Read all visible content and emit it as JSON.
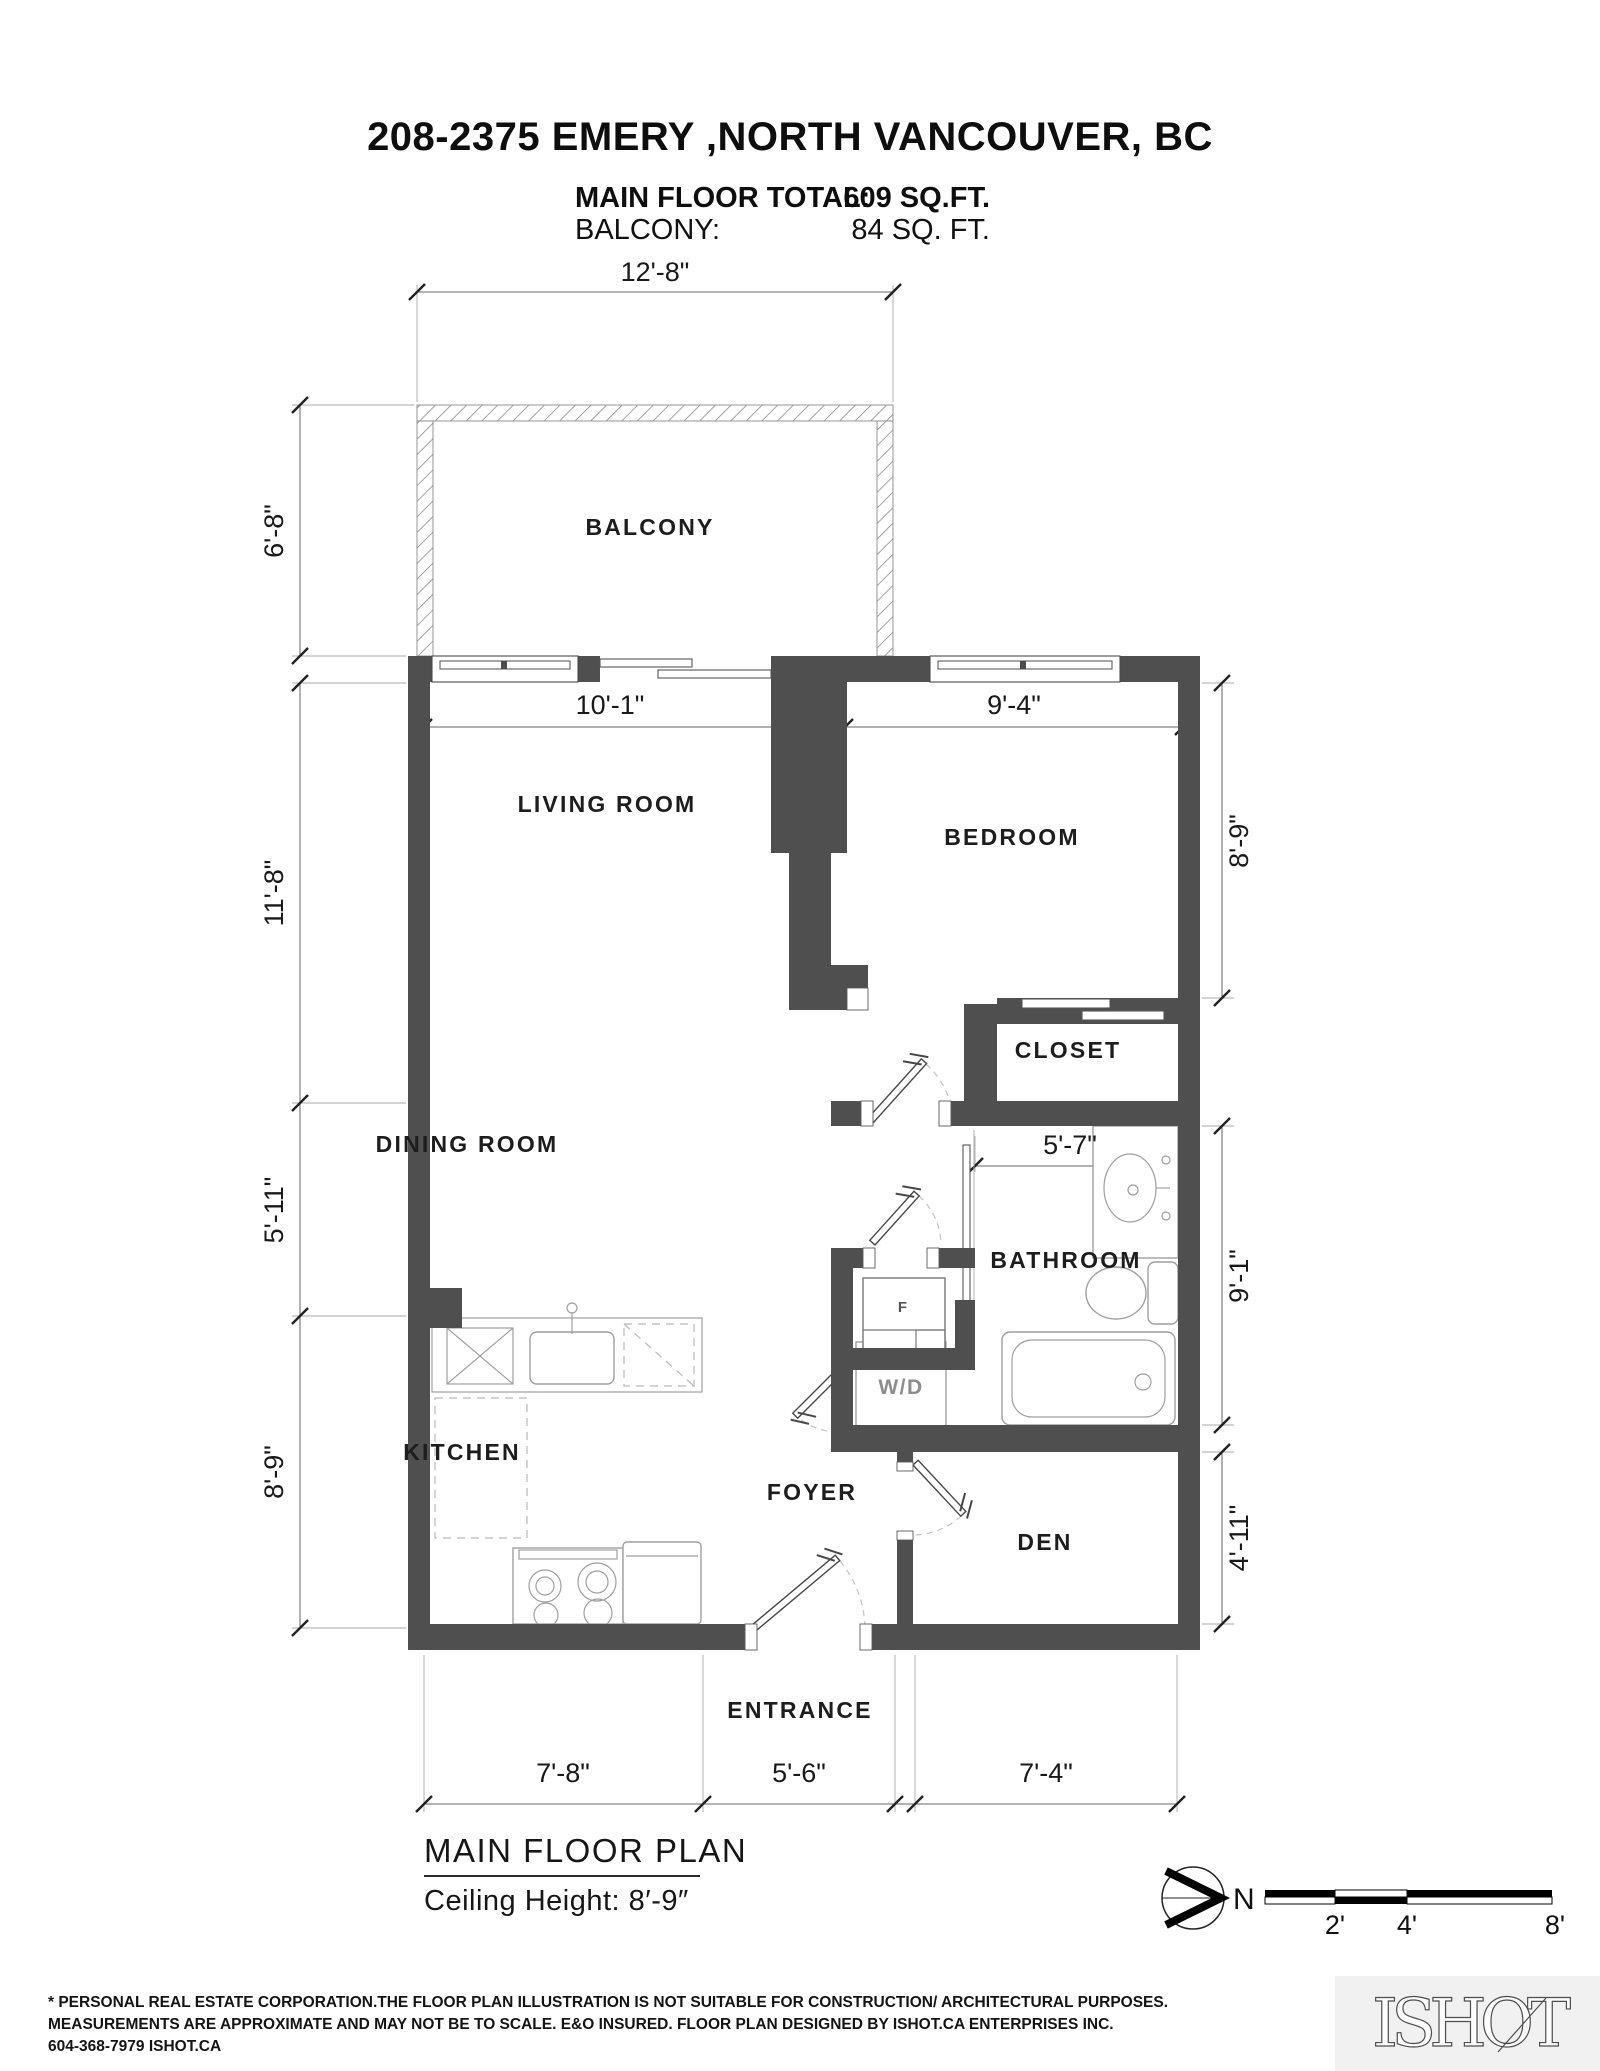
{
  "palette": {
    "wall": "#4f4f4f",
    "fixture": "#9f9f9f"
  },
  "header": {
    "address": "208-2375 EMERY ,NORTH VANCOUVER, BC",
    "main_floor_label": "MAIN FLOOR TOTAL:",
    "main_floor_value": "609 SQ.FT.",
    "balcony_label": "BALCONY:",
    "balcony_value": "84 SQ. FT."
  },
  "rooms": {
    "balcony": "BALCONY",
    "living_room": "LIVING ROOM",
    "bedroom": "BEDROOM",
    "closet": "CLOSET",
    "dining_room": "DINING ROOM",
    "bathroom": "BATHROOM",
    "kitchen": "KITCHEN",
    "foyer": "FOYER",
    "den": "DEN",
    "entrance": "ENTRANCE",
    "laundry": "W/D",
    "furnace": "F"
  },
  "dims": {
    "balcony_w": "12'-8\"",
    "balcony_d": "6'-8\"",
    "living_w": "10'-1\"",
    "bedroom_w": "9'-4\"",
    "living_h": "11'-8\"",
    "dining_h": "5'-11\"",
    "kitchen_h": "8'-9\"",
    "bedroom_h": "8'-9\"",
    "bath_w": "5'-7\"",
    "bathroom_h": "9'-1\"",
    "den_h": "4'-11\"",
    "kitchen_w": "7'-8\"",
    "entrance_w": "5'-6\"",
    "den_w": "7'-4\""
  },
  "plan_caption": {
    "name": "MAIN FLOOR PLAN",
    "ceiling": "Ceiling Height: 8′-9″"
  },
  "compass": {
    "north_label": "N"
  },
  "scale_bar": {
    "t2": "2'",
    "t4": "4'",
    "t8": "8'"
  },
  "footer": {
    "line1": "* PERSONAL REAL ESTATE CORPORATION.THE FLOOR PLAN ILLUSTRATION IS NOT SUITABLE FOR CONSTRUCTION/ ARCHITECTURAL PURPOSES.",
    "line2": "MEASUREMENTS ARE APPROXIMATE AND MAY NOT BE TO SCALE. E&O INSURED. FLOOR PLAN DESIGNED BY ISHOT.CA ENTERPRISES INC.",
    "line3": "604-368-7979  ISHOT.CA"
  },
  "logo": {
    "text": "ISHOT"
  }
}
